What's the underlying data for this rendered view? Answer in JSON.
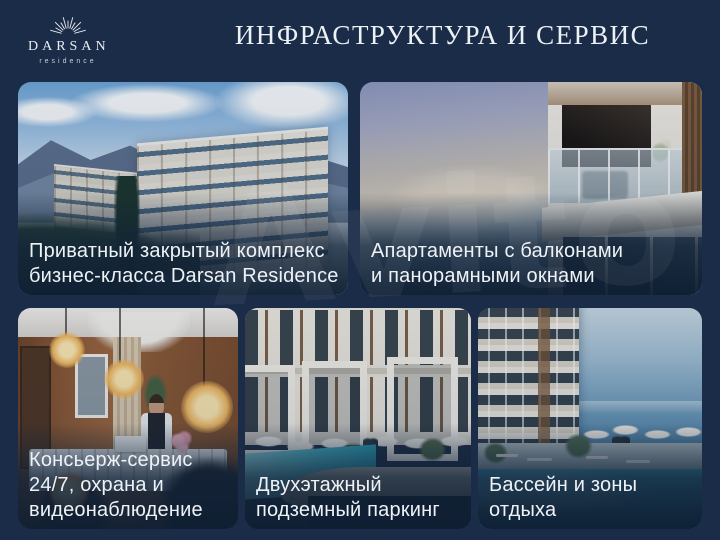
{
  "brand": {
    "name": "DARSAN",
    "tagline": "residence",
    "logo_icon": "sunburst-icon"
  },
  "header": {
    "title": "ИНФРАСТРУКТУРА И СЕРВИС"
  },
  "watermark": {
    "text": "Avito"
  },
  "cards": [
    {
      "id": "private-complex",
      "image_description": "render of apartment complex against mountains, trees and sky",
      "lines": [
        "Приватный закрытый комплекс",
        "бизнес-класса Darsan Residence"
      ]
    },
    {
      "id": "apartments-balconies",
      "image_description": "building corner with glass balcony over hazy sea sunset",
      "lines": [
        "Апартаменты с балконами",
        "и панорамными окнами"
      ]
    },
    {
      "id": "concierge",
      "image_description": "reception lobby with concierge at desk and edison bulbs",
      "lines": [
        "Консьерж-сервис",
        "24/7, охрана и",
        "видеонаблюдение"
      ]
    },
    {
      "id": "parking",
      "image_description": "courtyard pool over stone podium with car entering parking",
      "lines": [
        "Двухэтажный",
        "подземный паркинг"
      ]
    },
    {
      "id": "pool-zones",
      "image_description": "rooftop pool with loungers and umbrellas facing the sea",
      "lines": [
        "Бассейн и зоны",
        "отдыха"
      ]
    }
  ],
  "colors": {
    "background": "#1b2c48",
    "title_text": "#edf1f6",
    "caption_text": "#eef2f7",
    "logo_text": "#e9edf2"
  }
}
